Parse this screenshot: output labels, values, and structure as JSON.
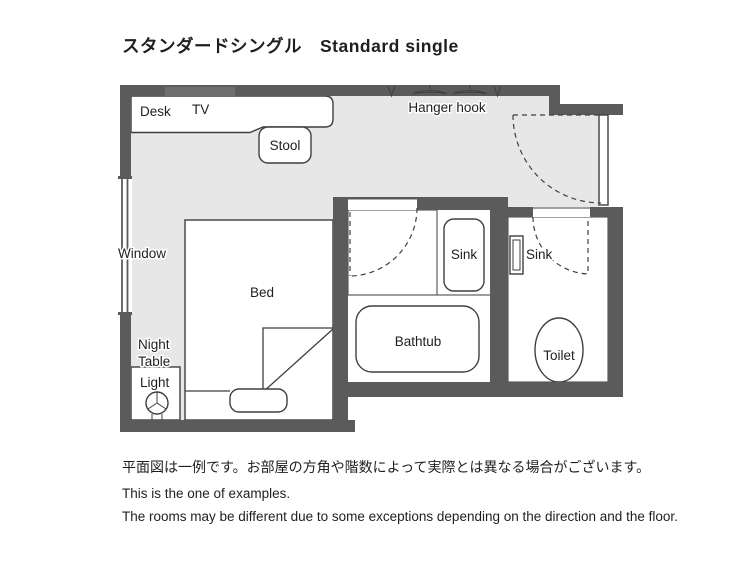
{
  "title": "スタンダードシングル　Standard single",
  "floor_plan": {
    "labels": {
      "desk": "Desk",
      "tv": "TV",
      "stool": "Stool",
      "hanger_hook": "Hanger hook",
      "window": "Window",
      "bed": "Bed",
      "night_table_line1": "Night",
      "night_table_line2": "Table",
      "light": "Light",
      "sink_bath": "Sink",
      "sink_toilet": "Sink",
      "bathtub": "Bathtub",
      "toilet": "Toilet"
    },
    "colors": {
      "wall": "#5b5b5b",
      "floor": "#e7e7e7",
      "tile": "#d3d3d3",
      "tile_line": "#ffffff",
      "fixture": "#ffffff",
      "line": "#3f3f3f",
      "tv": "#6e6e6e",
      "text": "#1f1f1f"
    }
  },
  "footer": {
    "jp": "平面図は一例です。お部屋の方角や階数によって実際とは異なる場合がございます。",
    "en1": "This is the one of examples.",
    "en2": "The rooms may be different due to some exceptions depending on the direction and the floor."
  }
}
